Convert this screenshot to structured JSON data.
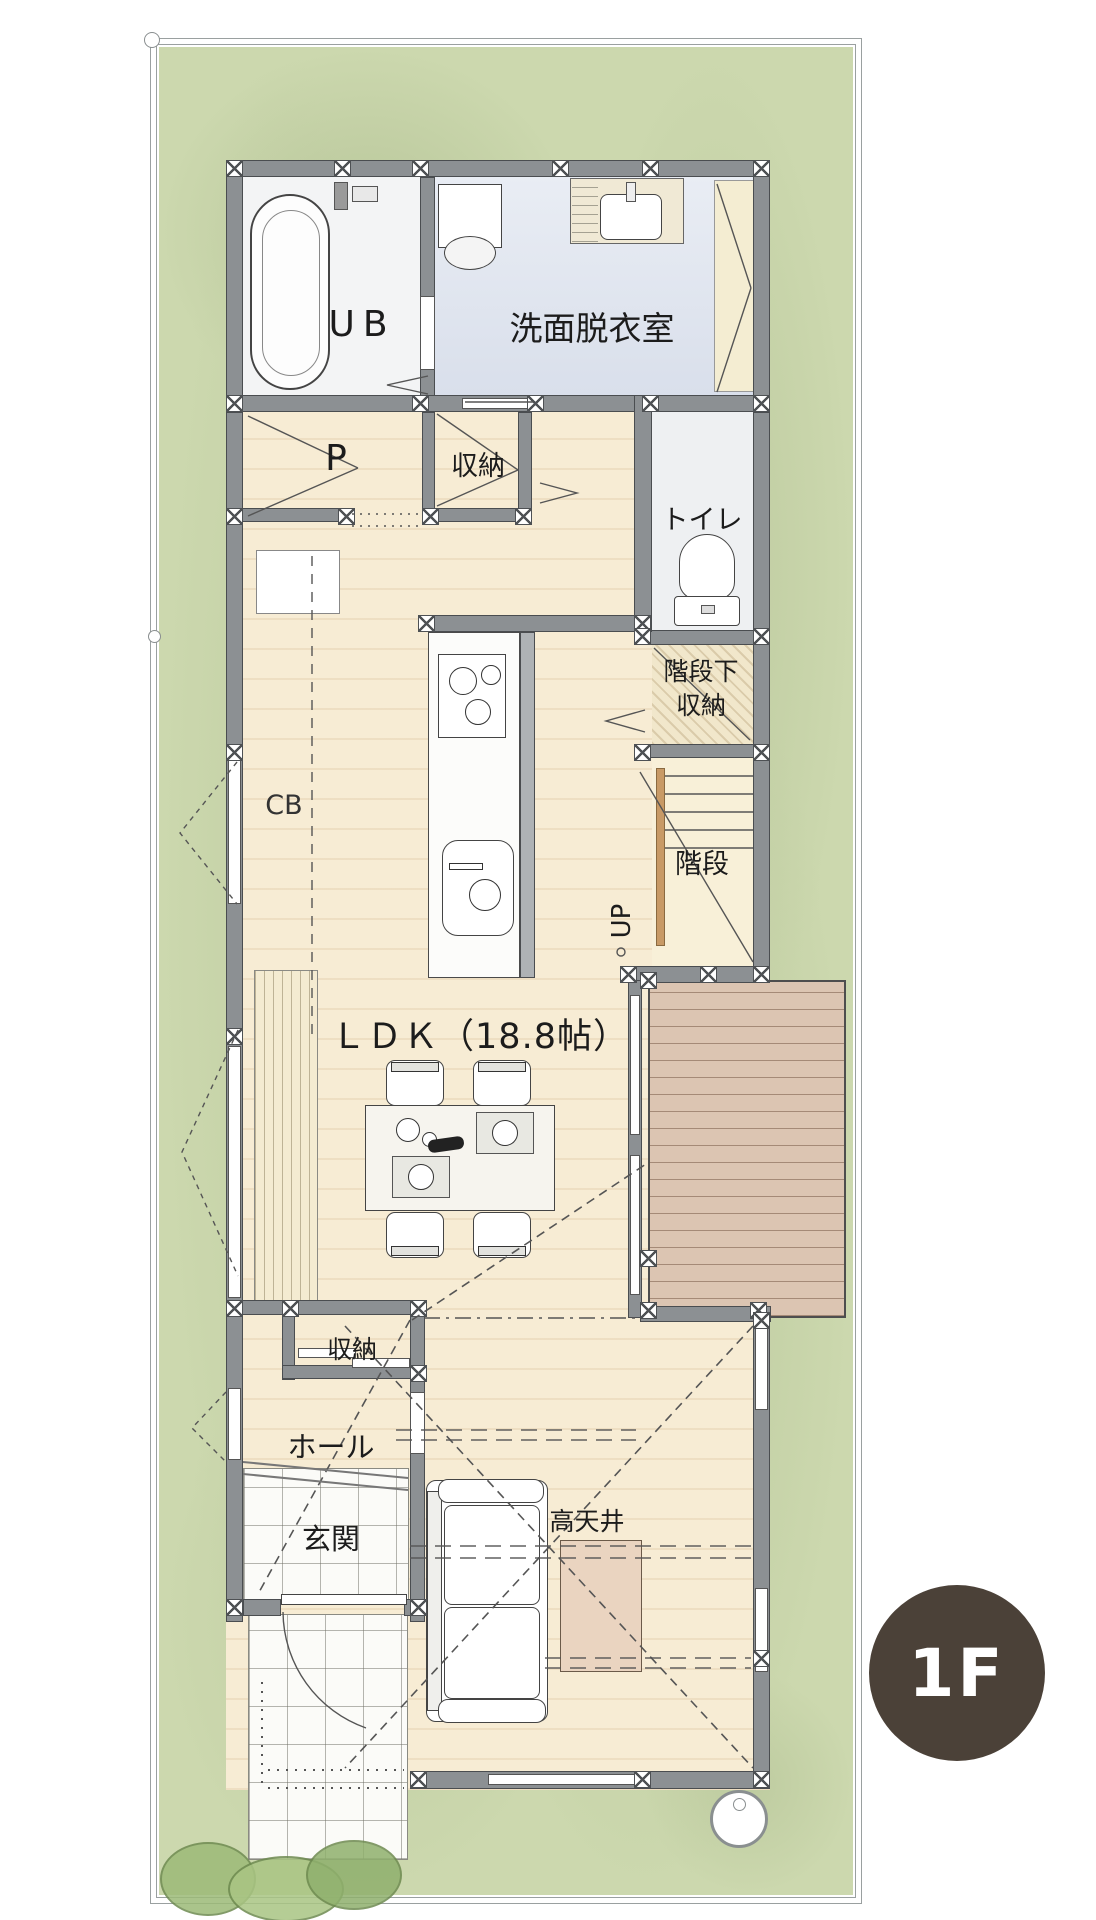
{
  "badge": {
    "text": "1F",
    "color": "#4b4138"
  },
  "rooms": {
    "ub": "UB",
    "washroom": "洗面脱衣室",
    "pantry": "P",
    "storage_upper": "収納",
    "toilet": "トイレ",
    "understair1": "階段下",
    "understair2": "収納",
    "stairs": "階段",
    "up": "UP",
    "cb": "CB",
    "ldk": "ＬＤＫ（18.8帖）",
    "storage_lower": "収納",
    "hall": "ホール",
    "entrance": "玄関",
    "high_ceiling": "高天井"
  },
  "palette": {
    "grass": "#ccd8ae",
    "floor": "#f7ecd4",
    "deck": "#dcc5b2",
    "washroom_floor": "#e2e7f0",
    "wall": "#8c9093",
    "badge_brown": "#4b4138"
  }
}
